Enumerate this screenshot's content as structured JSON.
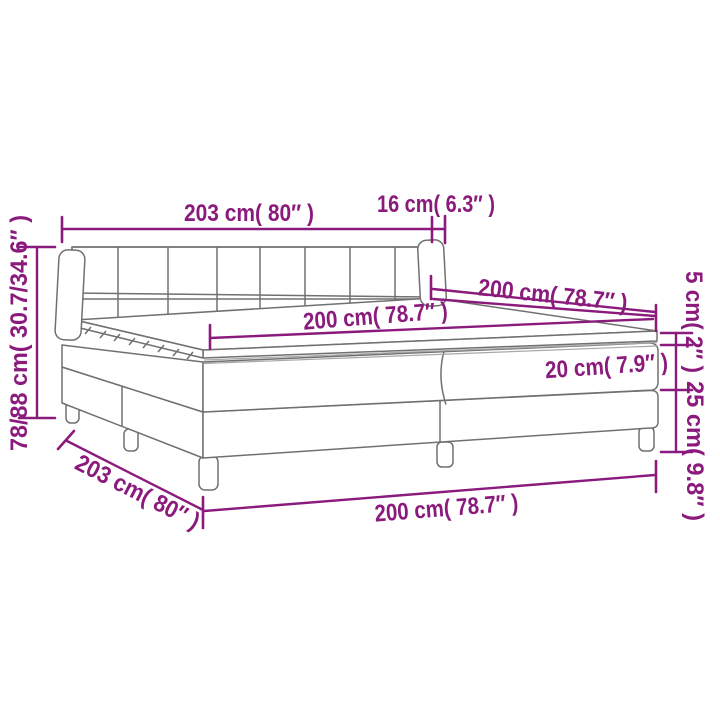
{
  "diagram": {
    "type": "product-dimension-diagram",
    "subject": "box spring bed with headboard, mattress and topper",
    "accent_color": "#8A1A7C",
    "line_color": "#707070",
    "background_color": "#ffffff",
    "labels": {
      "headboard_width": "203 cm( 80″ )",
      "headboard_depth": "16 cm( 6.3″ )",
      "overall_height": "78/88 cm( 30.7/34.6″ )",
      "bed_length_right": "200 cm( 78.7″ )",
      "mattress_length_top": "200 cm( 78.7″ )",
      "topper_thickness": "5 cm( 2″ )",
      "mattress_thickness": "20 cm( 7.9″ )",
      "base_height": "25 cm( 9.8″ )",
      "bed_width_left": "203 cm( 80″ )",
      "base_length_front": "200 cm( 78.7″ )"
    }
  }
}
